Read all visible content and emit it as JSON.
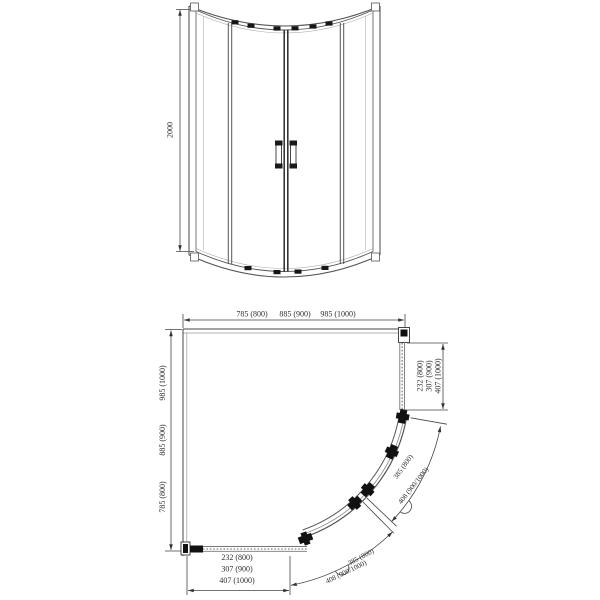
{
  "drawing": {
    "front_view": {
      "height_dim": "2000"
    },
    "plan_view": {
      "top_width_dims": [
        "785 (800)",
        "885 (900)",
        "985 (1000)"
      ],
      "left_depth_dims": [
        "785 (800)",
        "885 (900)",
        "985 (1000)"
      ],
      "right_panel_dims": [
        "232 (800)",
        "307 (900)",
        "407 (1000)"
      ],
      "bottom_panel_dims": [
        "232 (800)",
        "307 (900)",
        "407 (1000)"
      ],
      "right_door_arc_dims": [
        "385 (800)",
        "408 (900/1000)"
      ],
      "bottom_door_arc_dims": [
        "385 (800)",
        "408 (900/1000)"
      ]
    }
  }
}
